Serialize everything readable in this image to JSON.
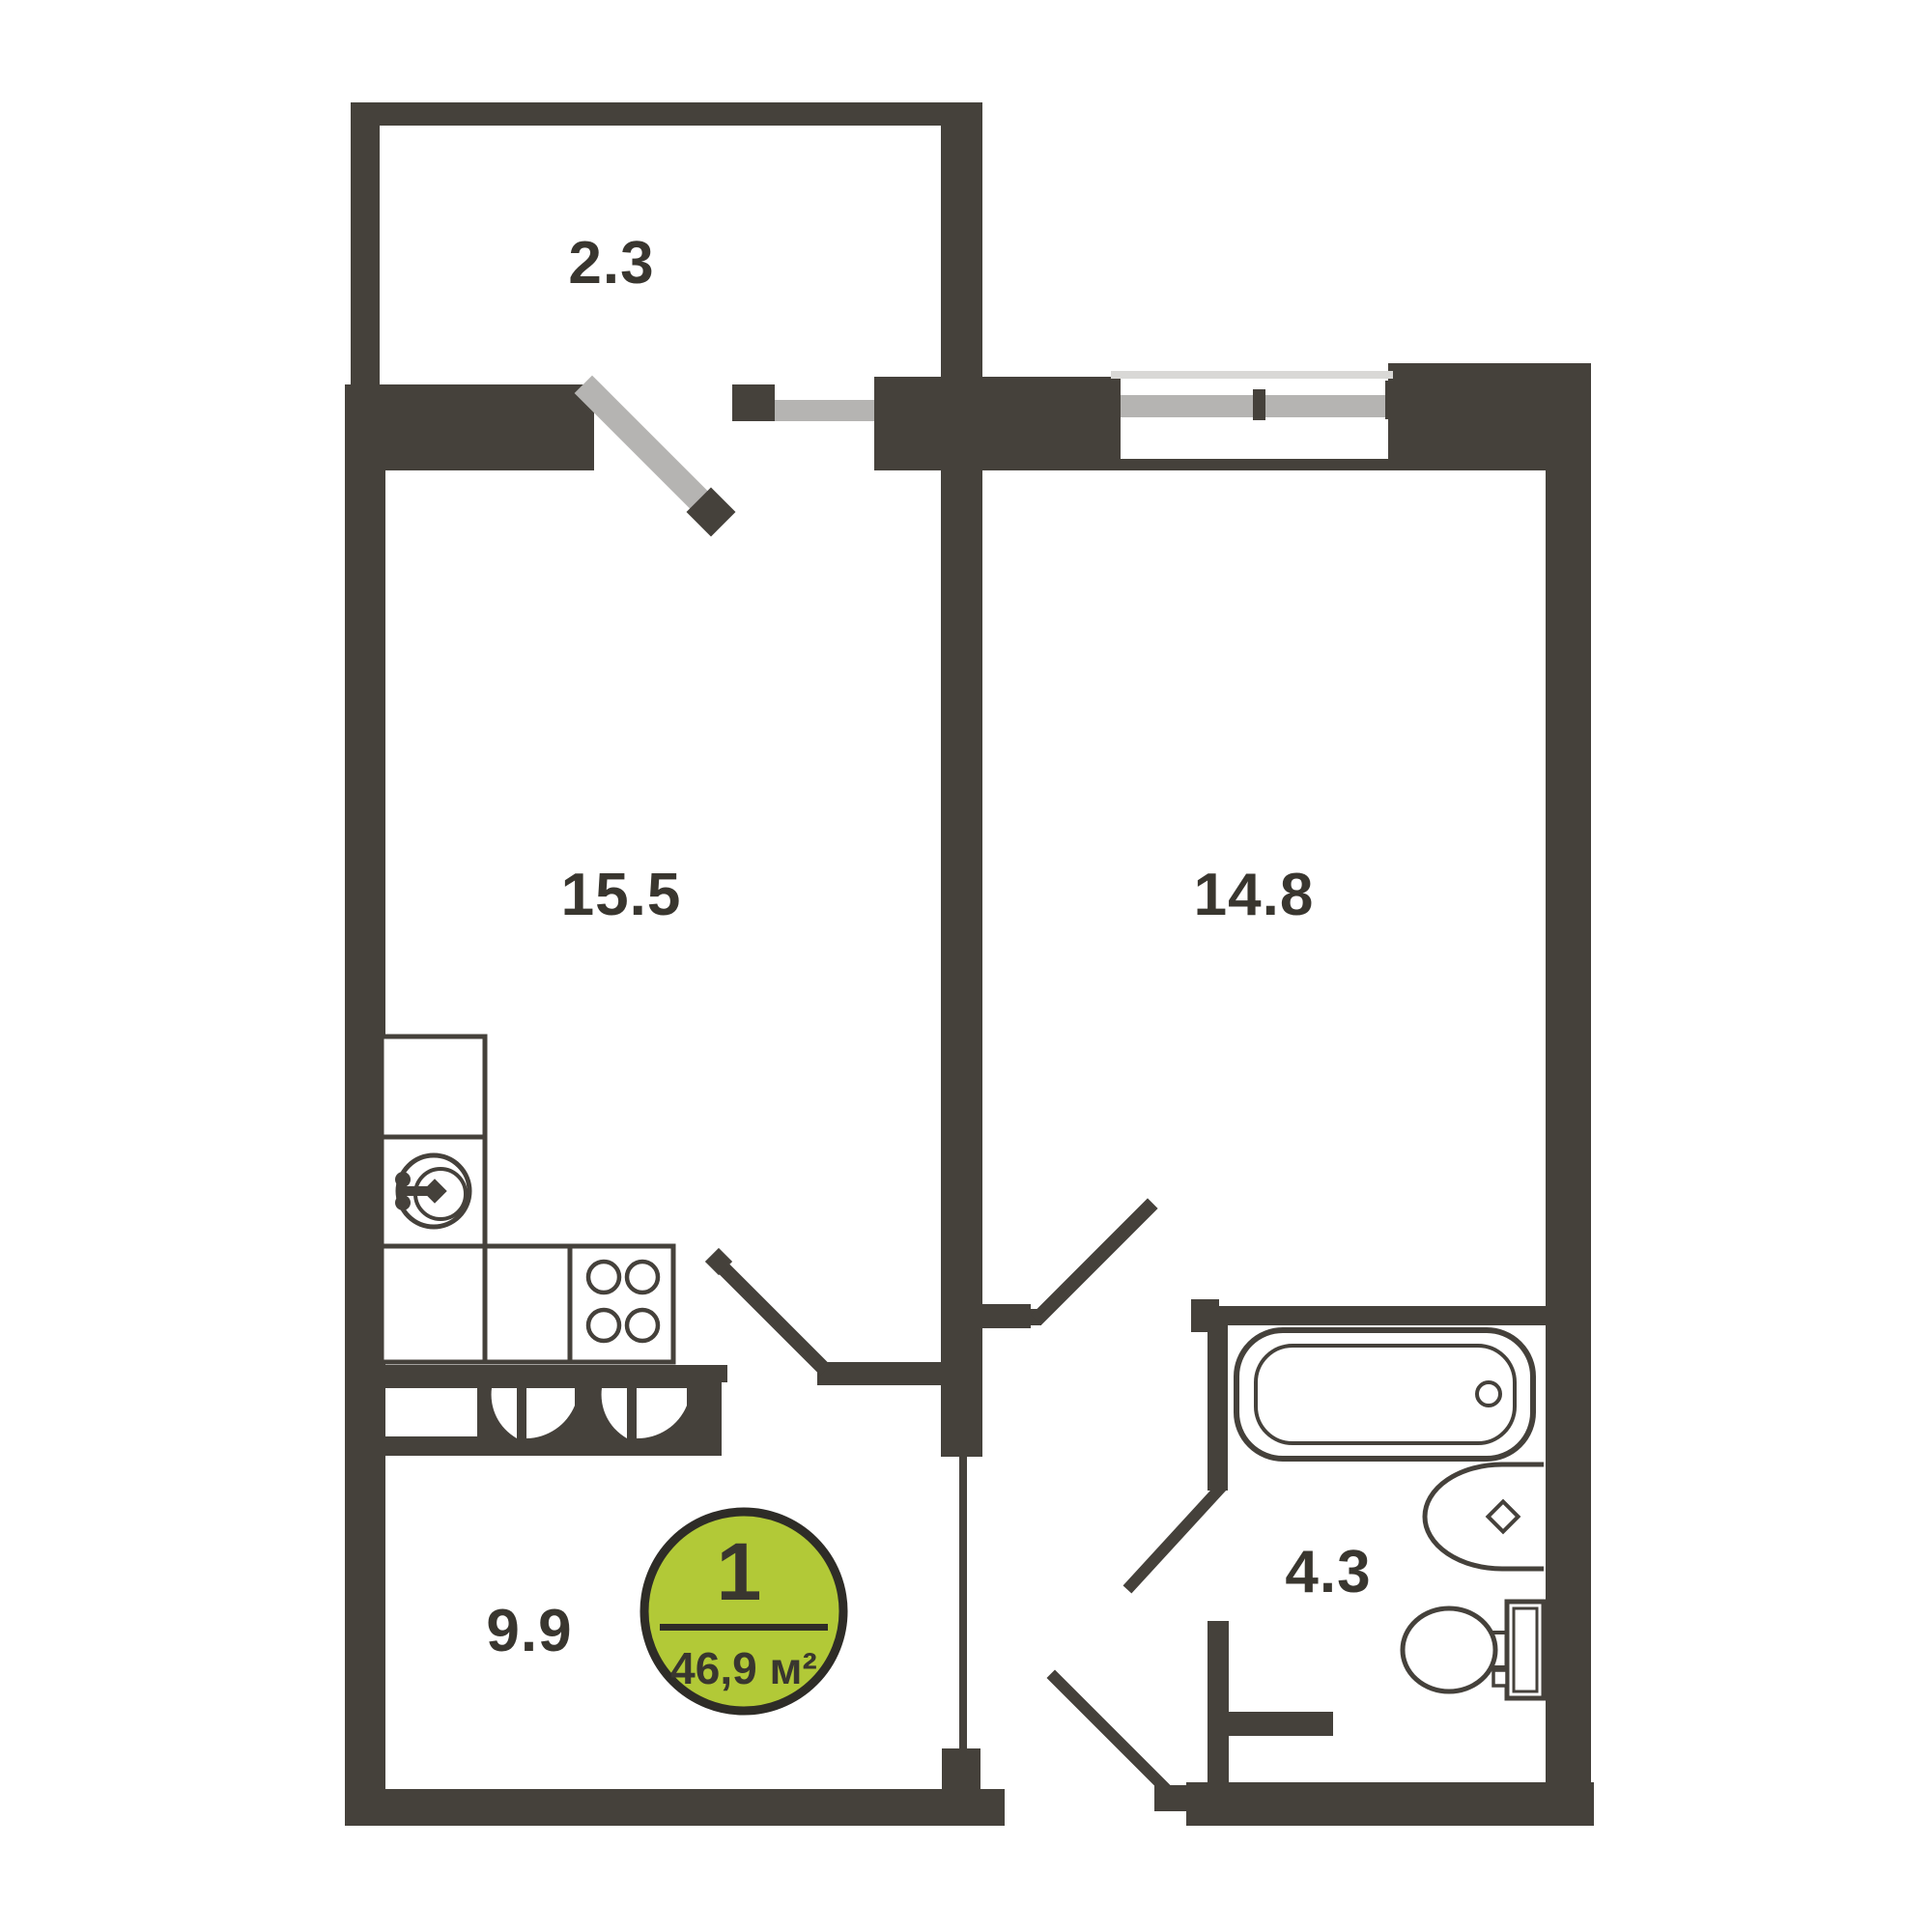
{
  "plan": {
    "badge": {
      "rooms_count": "1",
      "total_area": "46,9 м²"
    },
    "rooms": {
      "balcony": {
        "area": "2.3"
      },
      "kitchen": {
        "area": "15.5"
      },
      "living": {
        "area": "14.8"
      },
      "hall": {
        "area": "9.9"
      },
      "bathroom": {
        "area": "4.3"
      }
    },
    "colors": {
      "wall": "#45413b",
      "door_gray": "#b5b4b2",
      "window_light": "#d9d8d6",
      "accent_green": "#b2c937",
      "text": "#39362f"
    }
  }
}
